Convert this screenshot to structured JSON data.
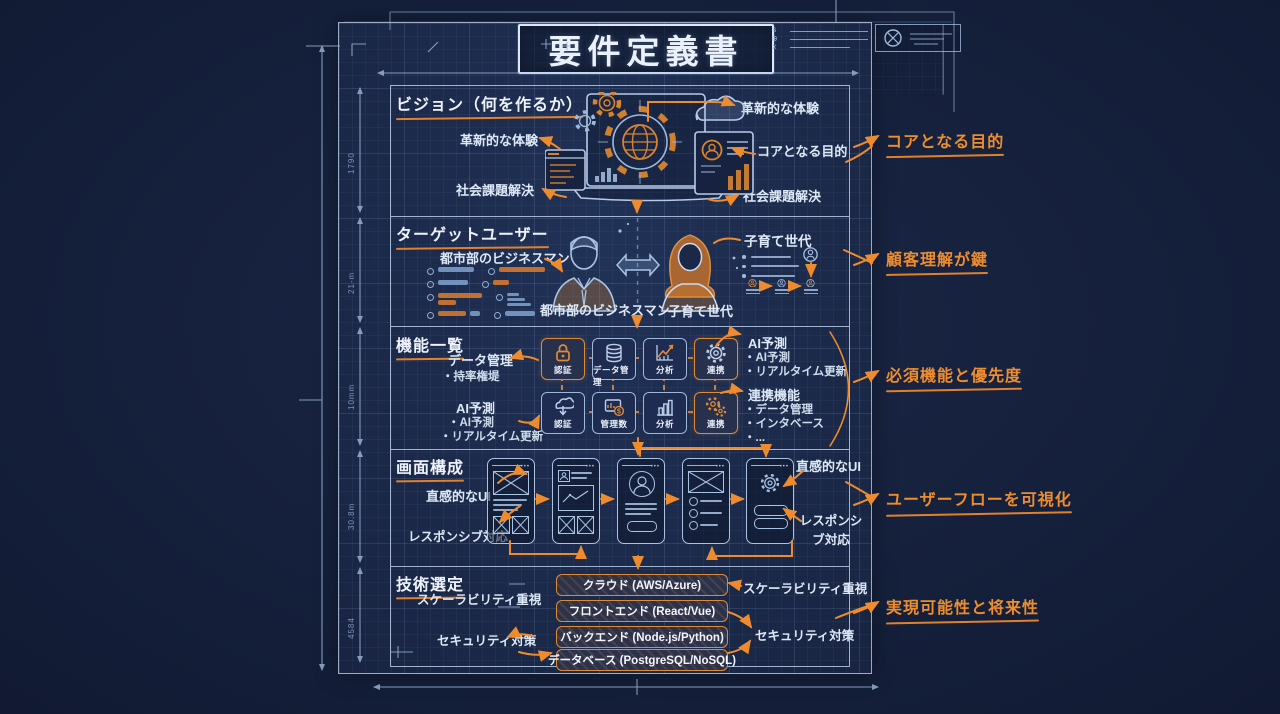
{
  "page": {
    "title": "要件定義書"
  },
  "title_block": {
    "marks": [
      "s",
      "⊕",
      "x"
    ]
  },
  "sections": [
    {
      "id": "vision",
      "heading": "ビジョン（何を作るか）",
      "left": [
        "革新的な体験",
        "社会課題解決"
      ],
      "right": [
        "革新的な体験",
        "コアとなる目的",
        "社会課題解決"
      ]
    },
    {
      "id": "target-users",
      "heading": "ターゲットユーザー",
      "left_label": "都市部のビジネスマン",
      "persona_male": "都市部のビジネスマン",
      "persona_female": "子育て世代",
      "right_label": "子育て世代"
    },
    {
      "id": "features",
      "heading": "機能一覧",
      "left1_title": "データ管理",
      "left1_sub": "・持率権堤",
      "left2": [
        "AI予測",
        "・AI予測",
        "・リアルタイム更新"
      ],
      "row1": [
        {
          "label": "認証",
          "icon": "lock-icon"
        },
        {
          "label": "データ管理",
          "icon": "database-icon"
        },
        {
          "label": "分析",
          "icon": "line-chart-icon"
        },
        {
          "label": "連携",
          "icon": "gear-icon"
        }
      ],
      "row2": [
        {
          "label": "認証",
          "icon": "cloud-icon"
        },
        {
          "label": "管理数",
          "icon": "monitor-icon"
        },
        {
          "label": "分析",
          "icon": "bar-chart-icon"
        },
        {
          "label": "連携",
          "icon": "gears-icon"
        }
      ],
      "right1": [
        "AI予測",
        "・AI予測",
        "・リアルタイム更新"
      ],
      "right2": [
        "連携機能",
        "・データ管理",
        "・インタベース",
        "・..."
      ]
    },
    {
      "id": "screens",
      "heading": "画面構成",
      "left": [
        "直感的なUI",
        "レスポンシブ対応"
      ],
      "right": [
        "直感的なUI",
        "レスポンシブ対応"
      ]
    },
    {
      "id": "tech",
      "heading": "技術選定",
      "left": [
        "スケーラビリティ重視",
        "セキュリティ対策"
      ],
      "stack": [
        "クラウド (AWS/Azure)",
        "フロントエンド (React/Vue)",
        "バックエンド (Node.js/Python)",
        "データベース (PostgreSQL/NoSQL)"
      ],
      "right": [
        "スケーラビリティ重視",
        "セキュリティ対策"
      ]
    }
  ],
  "annotations": [
    "コアとなる目的",
    "顧客理解が鍵",
    "必須機能と優先度",
    "ユーザーフローを可視化",
    "実現可能性と将来性"
  ],
  "dimensions": {
    "left_marks": [
      "1790",
      "21-m",
      "10mm",
      "30.8m",
      "4584"
    ]
  },
  "colors": {
    "accent_orange": "#ED8B2D",
    "line_blue": "#9FB9DC",
    "text_white": "#E9F0FA",
    "sheet": "#1B2847"
  }
}
